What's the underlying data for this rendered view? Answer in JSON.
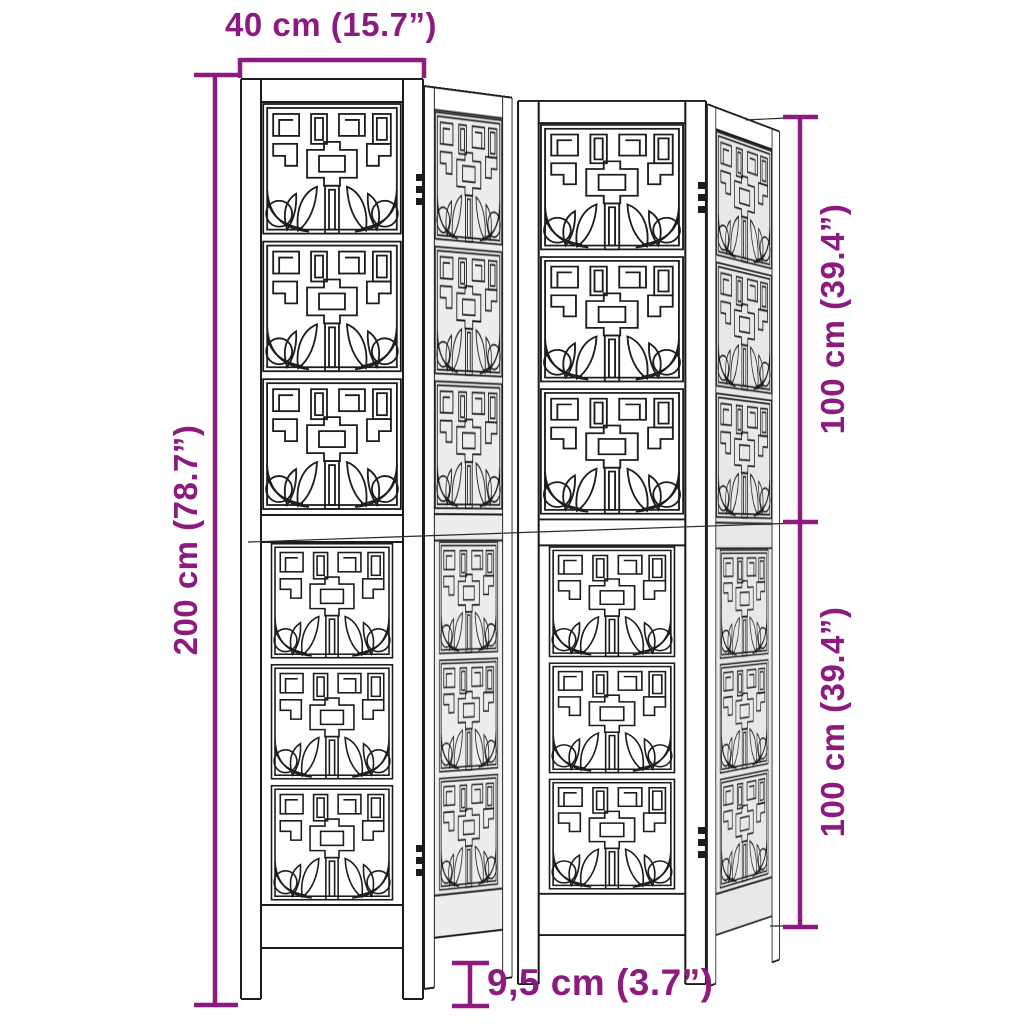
{
  "product": {
    "name": "4-panel wooden room divider with fretwork pattern",
    "panel_count": 4
  },
  "dimensions": {
    "top_width": {
      "label": "40 cm (15.7”)"
    },
    "left_height": {
      "label": "200 cm (78.7”)"
    },
    "right_upper": {
      "label": "100 cm (39.4”)"
    },
    "right_lower": {
      "label": "100 cm (39.4”)"
    },
    "bottom_depth": {
      "label": "9,5 cm (3.7”)"
    }
  },
  "colors": {
    "dimension_accent": "#8d1a7e",
    "line_art": "#1c1c1c",
    "background": "#ffffff"
  }
}
